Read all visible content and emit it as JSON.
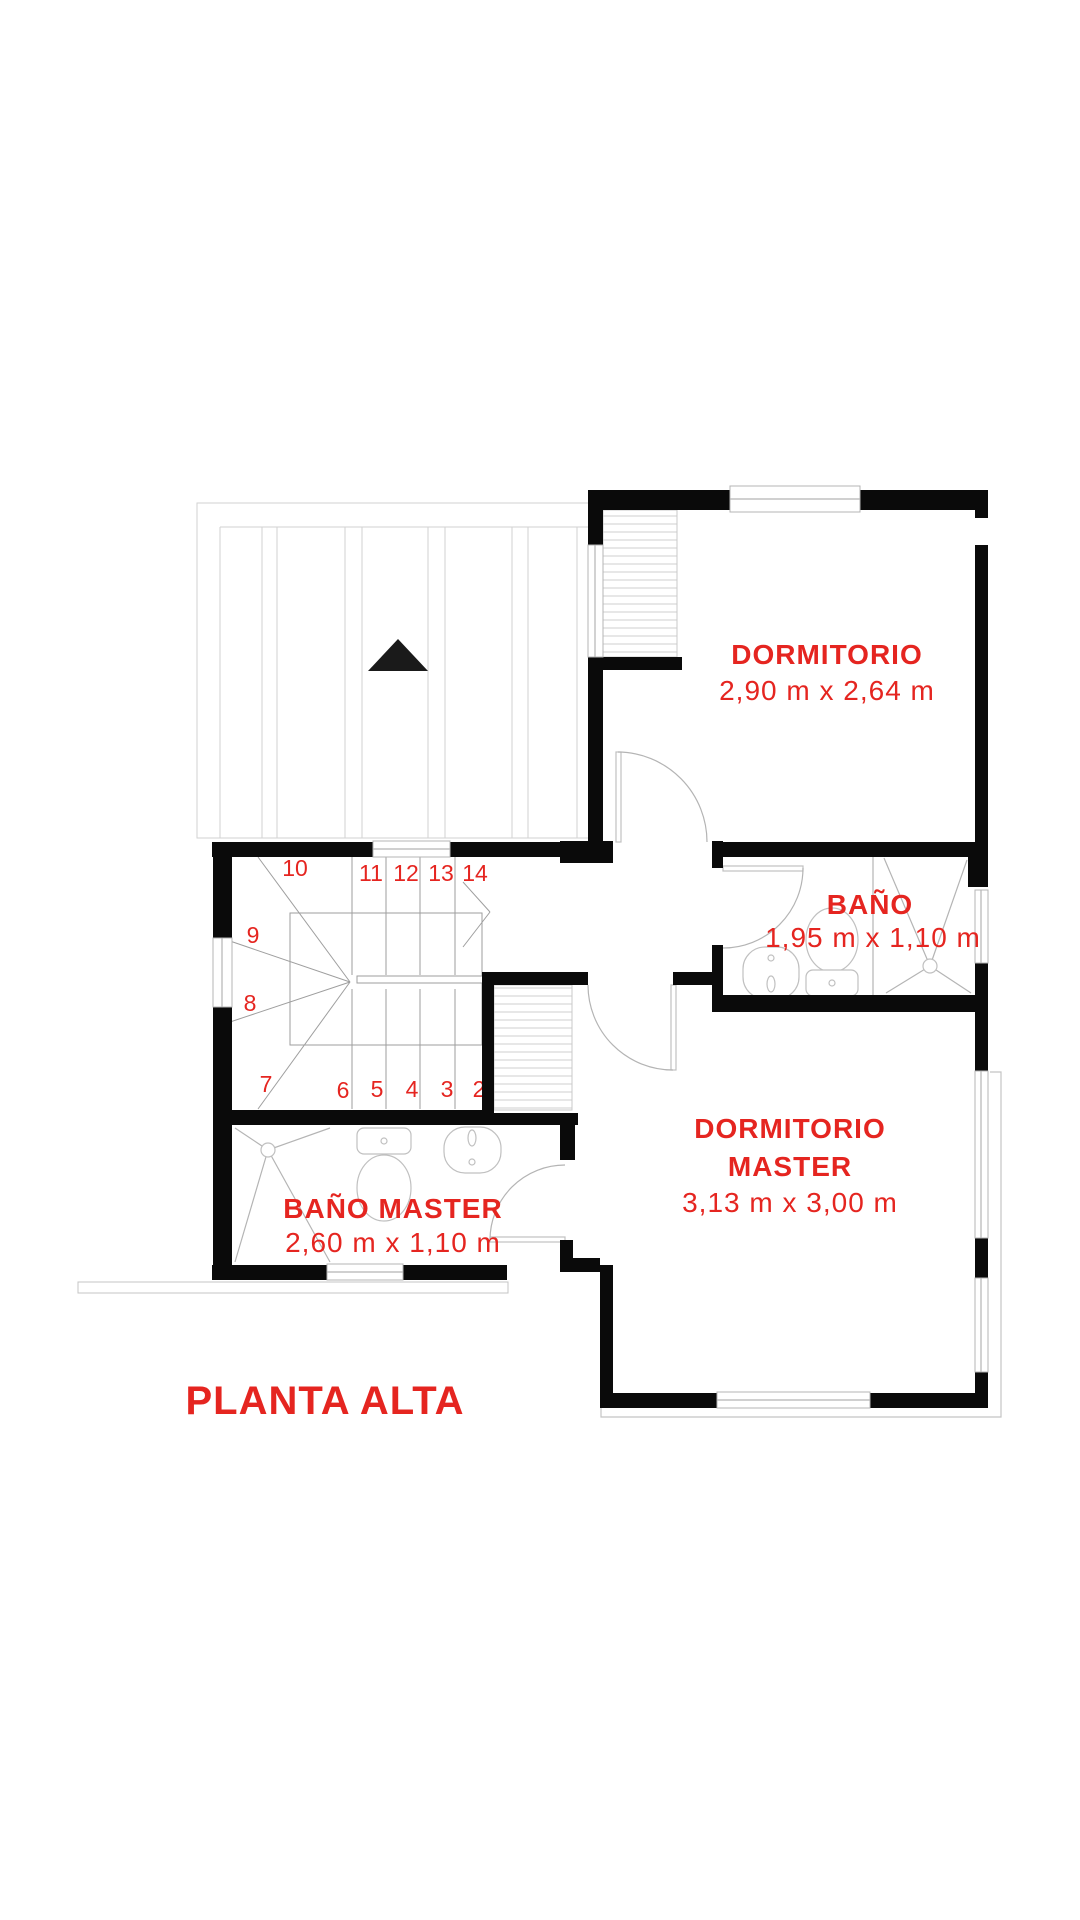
{
  "plan": {
    "title": "PLANTA ALTA",
    "rooms": {
      "dormitorio": {
        "name": "DORMITORIO",
        "dims": "2,90 m x 2,64 m"
      },
      "bano": {
        "name": "BAÑO",
        "dims": "1,95 m x 1,10 m"
      },
      "dormitorio_master": {
        "name_line1": "DORMITORIO",
        "name_line2": "MASTER",
        "dims": "3,13 m x 3,00 m"
      },
      "bano_master": {
        "name": "BAÑO MASTER",
        "dims": "2,60 m x 1,10 m"
      }
    },
    "stair_steps": [
      "2",
      "3",
      "4",
      "5",
      "6",
      "7",
      "8",
      "9",
      "10",
      "11",
      "12",
      "13",
      "14"
    ],
    "colors": {
      "accent": "#e52520",
      "wall": "#0a0a0a",
      "thin_line": "#b4b4b4"
    }
  }
}
